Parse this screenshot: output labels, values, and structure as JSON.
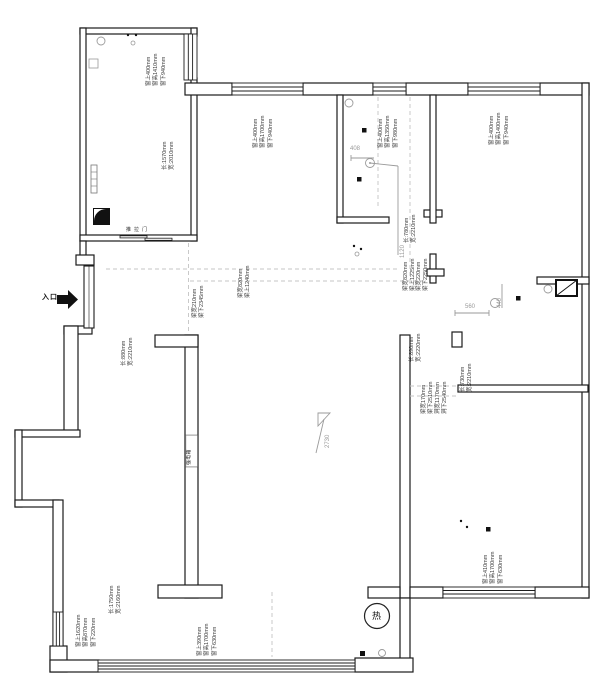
{
  "drawing": {
    "type": "apartment-survey-floor-plan",
    "wall_color": "#1c1c1c",
    "guide_color": "#c4c4c4",
    "dim_color": "#9a9a9a"
  },
  "labels": {
    "entrance": "入口",
    "sliding_door": "推拉门",
    "electric_box": "强电箱",
    "water_heater": "热",
    "level_height": "2730",
    "d408": "408",
    "d1120": "1120",
    "d560": "560",
    "d440": "440"
  },
  "ann": {
    "win_topleft": "窗上400mm\n窗高1410mm\n窗下940mm",
    "win_room2": "窗上400mm\n窗高1700mm\n窗下940mm",
    "win_bath1": "窗上400mm\n窗高1350mm\n窗下980mm",
    "win_topright": "窗上400mm\n窗高1400mm\n窗下940mm",
    "win_bottomleft": "窗上1620mm\n窗高870mm\n窗下220mm",
    "win_balcony": "窗上390mm\n窗高1700mm\n窗下630mm",
    "win_bedroom": "窗上410mm\n窗高1700mm\n窗下630mm",
    "dims_topleft": "长:1570mm\n宽:2010mm",
    "dims_bath1": "长:780mm\n宽:2210mm",
    "dims_hall": "长:880mm\n宽:2210mm",
    "dims_niche": "长:890mm\n宽:2220mm",
    "dims_730": "长:730mm\n宽:2210mm",
    "dims_bottomleft": "长:1750mm\n宽:2160mm",
    "beam_center_a": "梁宽820mm\n梁上1225mm",
    "beam_center_b": "梁宽220mm\n梁下2250mm",
    "beam_entry_a": "梁宽210mm\n梁下2345mm",
    "beam_entry_b": "梁宽820mm\n梁上1240mm",
    "beam_open_a": "梁宽170mm\n梁下2510mm",
    "opening": "洞宽1170mm\n洞下2540mm"
  }
}
